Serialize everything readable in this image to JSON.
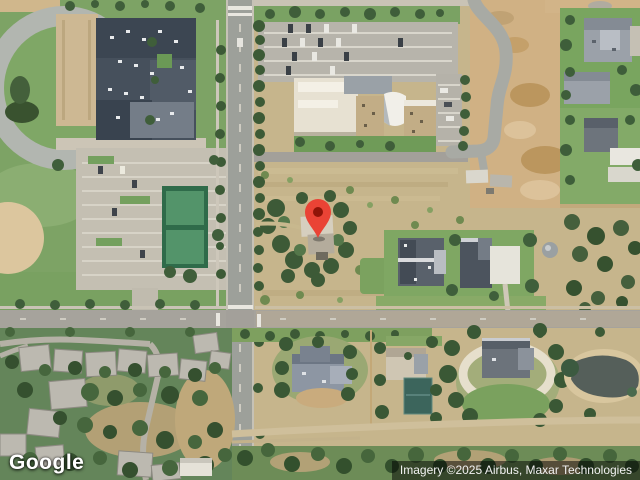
{
  "map": {
    "view_type": "satellite",
    "provider_logo": "Google",
    "attribution": "Imagery ©2025 Airbus, Maxar Technologies",
    "marker": {
      "icon": "map-pin-icon",
      "fill": "#EA4335",
      "dot": "#8F1408",
      "transform": "translate(318,212)"
    },
    "colors": {
      "attribution_bg": "rgba(0,0,0,0.5)",
      "attribution_text": "#f1f1f1",
      "logo_text": "#ffffff"
    }
  }
}
